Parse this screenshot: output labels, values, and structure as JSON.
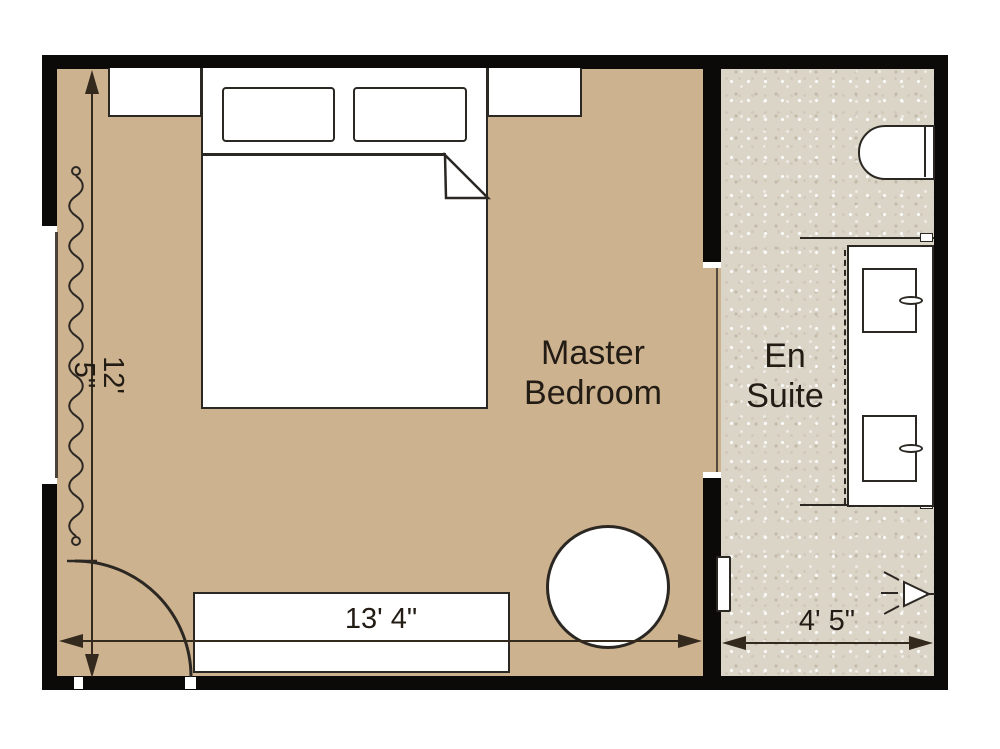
{
  "rooms": {
    "master_bedroom": {
      "label": "Master Bedroom",
      "width_dim": "13' 4\"",
      "height_dim": "12' 5\""
    },
    "en_suite": {
      "label": "En Suite",
      "width_dim": "4' 5\""
    }
  },
  "icons": {
    "bed": "double-bed-with-pillows-and-folded-blanket",
    "nightstands": "bedside-tables-flanking-bed",
    "dresser": "long-dresser-bottom-wall",
    "stool": "round-table",
    "toilet": "toilet-top-right",
    "vanity": "double-sink-vanity-right-wall",
    "sconce": "wall-light-with-rays",
    "door": "quarter-circle-door-swing",
    "curtain": "wavy-curtain-line-left-window"
  },
  "colors": {
    "bedroom_floor": "#cdb28f",
    "ensuite_floor": "#dbd5c8",
    "wall": "#0c0a08",
    "line": "#2b2722",
    "dimension": "#33291c",
    "text": "#221c15"
  }
}
